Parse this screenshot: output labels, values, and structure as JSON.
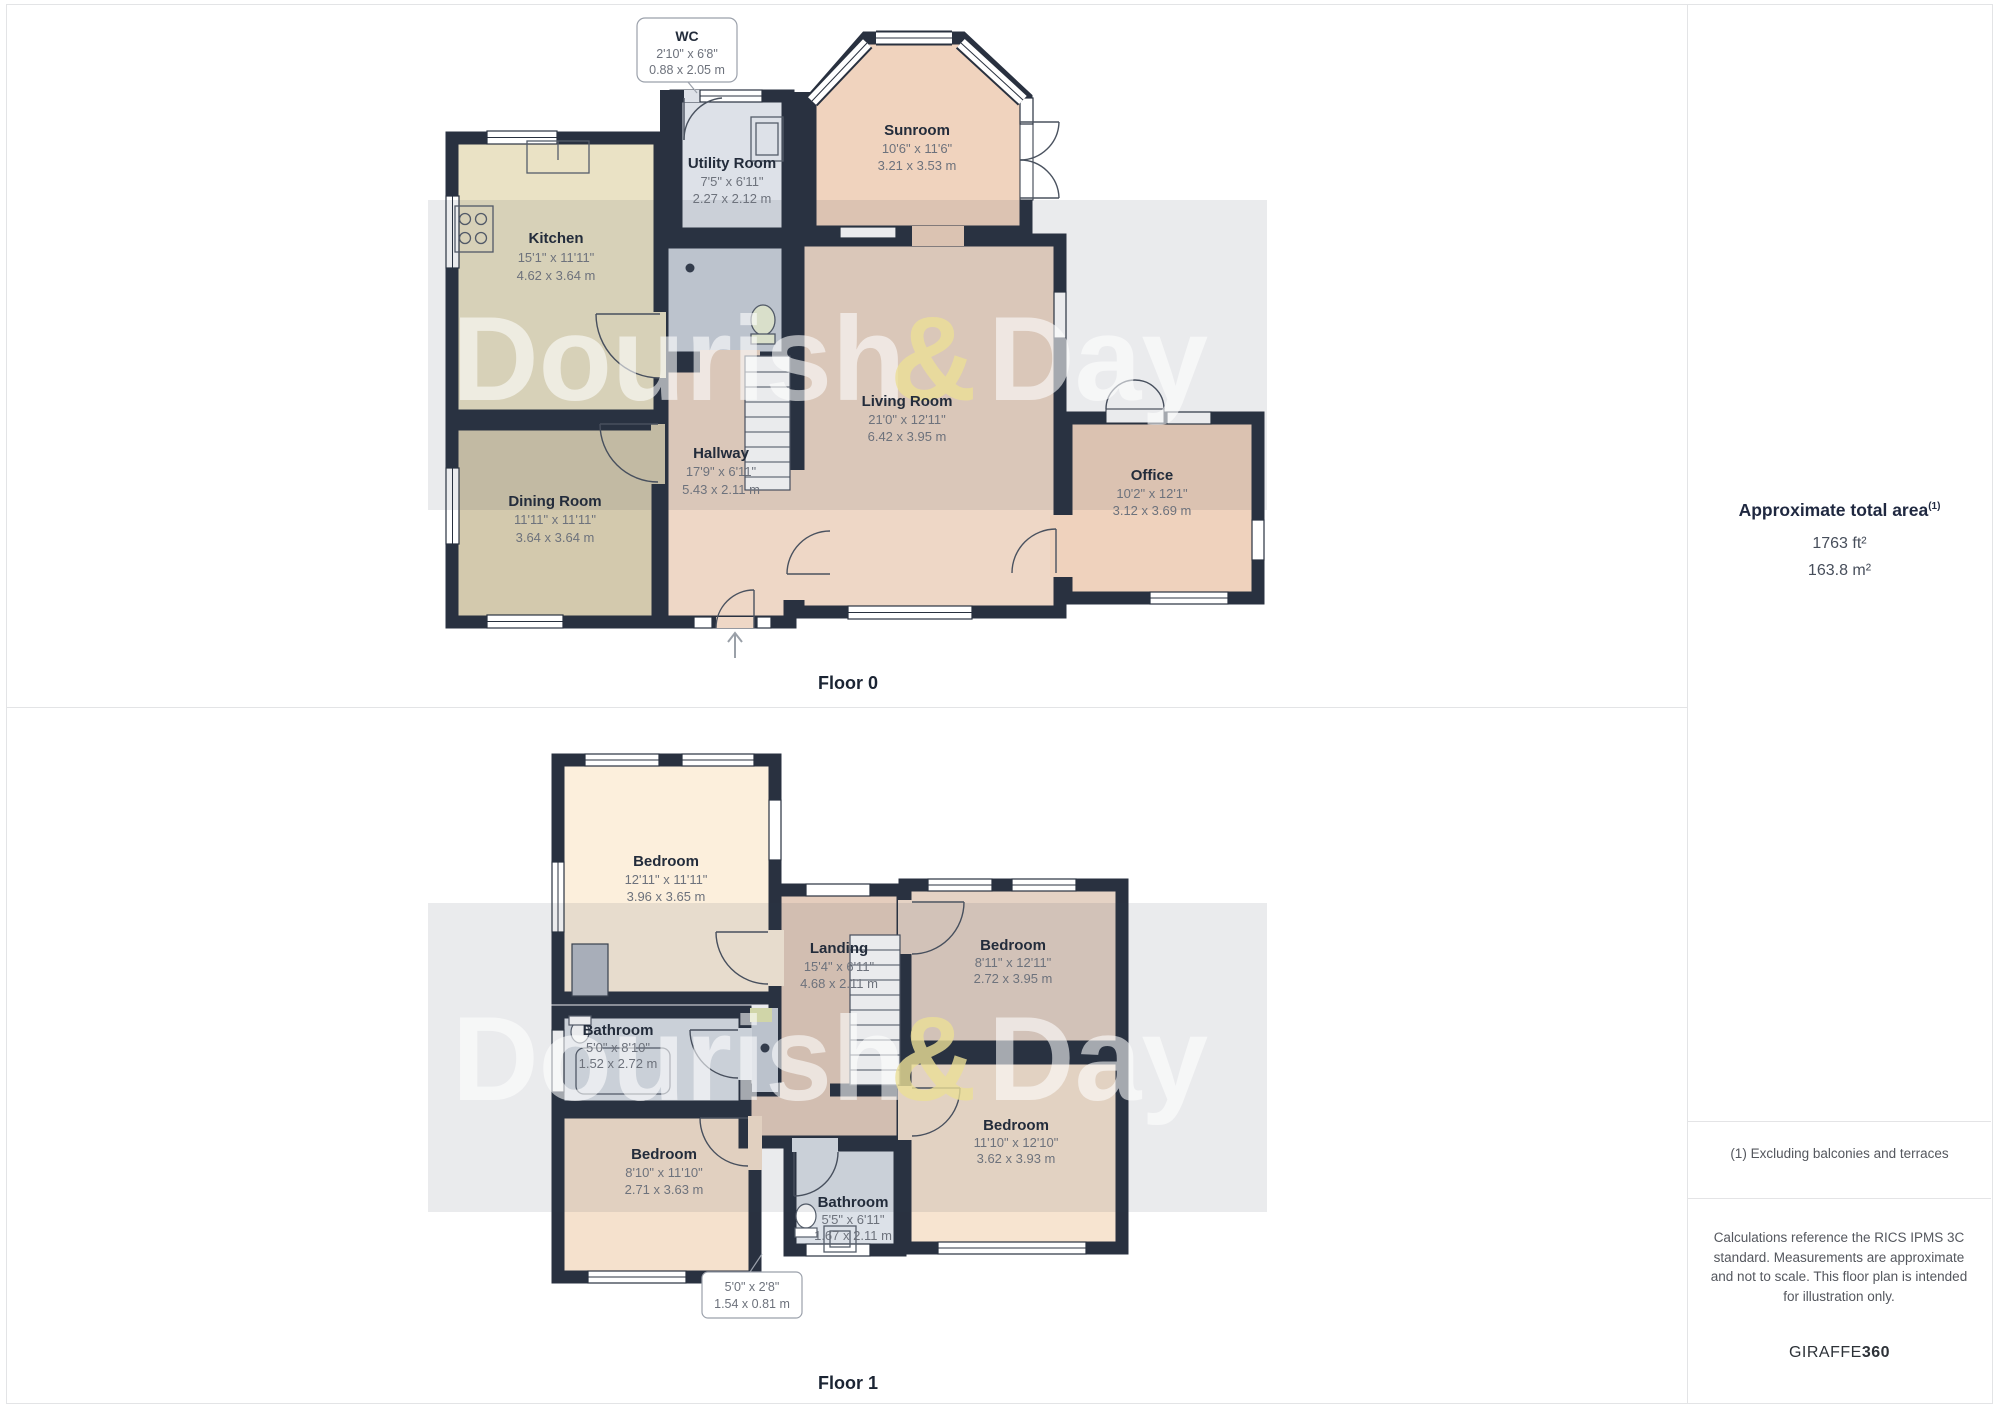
{
  "watermark": {
    "left": "Dourish",
    "amp": "&",
    "right": "Day"
  },
  "floor0": {
    "label": "Floor 0",
    "rooms": [
      {
        "name": "WC",
        "ft": "2'10\" x 6'8\"",
        "m": "0.88 x 2.05 m"
      },
      {
        "name": "Utility Room",
        "ft": "7'5\" x 6'11\"",
        "m": "2.27 x 2.12 m"
      },
      {
        "name": "Sunroom",
        "ft": "10'6\" x 11'6\"",
        "m": "3.21 x 3.53 m"
      },
      {
        "name": "Kitchen",
        "ft": "15'1\" x 11'11\"",
        "m": "4.62 x 3.64 m"
      },
      {
        "name": "Living Room",
        "ft": "21'0\" x 12'11\"",
        "m": "6.42 x 3.95 m"
      },
      {
        "name": "Hallway",
        "ft": "17'9\" x 6'11\"",
        "m": "5.43 x 2.11 m"
      },
      {
        "name": "Dining Room",
        "ft": "11'11\" x 11'11\"",
        "m": "3.64 x 3.64 m"
      },
      {
        "name": "Office",
        "ft": "10'2\" x 12'1\"",
        "m": "3.12 x 3.69 m"
      }
    ]
  },
  "floor1": {
    "label": "Floor 1",
    "rooms": [
      {
        "name": "Bedroom",
        "ft": "12'11\" x 11'11\"",
        "m": "3.96 x 3.65 m"
      },
      {
        "name": "Landing",
        "ft": "15'4\" x 6'11\"",
        "m": "4.68 x 2.11 m"
      },
      {
        "name": "Bedroom",
        "ft": "8'11\" x 12'11\"",
        "m": "2.72 x 3.95 m"
      },
      {
        "name": "Bathroom",
        "ft": "5'0\" x 8'10\"",
        "m": "1.52 x 2.72 m"
      },
      {
        "name": "Bedroom",
        "ft": "8'10\" x 11'10\"",
        "m": "2.71 x 3.63 m"
      },
      {
        "name": "Bedroom",
        "ft": "11'10\" x 12'10\"",
        "m": "3.62 x 3.93 m"
      },
      {
        "name": "Bathroom",
        "ft": "5'5\" x 6'11\"",
        "m": "1.67 x 2.11 m"
      },
      {
        "name": "",
        "ft": "5'0\" x 2'8\"",
        "m": "1.54 x 0.81 m"
      }
    ]
  },
  "sidebar": {
    "area_title": "Approximate total area",
    "area_sup": "(1)",
    "area_ft": "1763 ft²",
    "area_m": "163.8 m²",
    "footnote": "(1) Excluding balconies and terraces",
    "disclaimer": "Calculations reference the RICS IPMS 3C standard. Measurements are approximate and not to scale. This floor plan is intended for illustration only.",
    "brand_name": "GIRAFFE",
    "brand_suffix": "360"
  }
}
